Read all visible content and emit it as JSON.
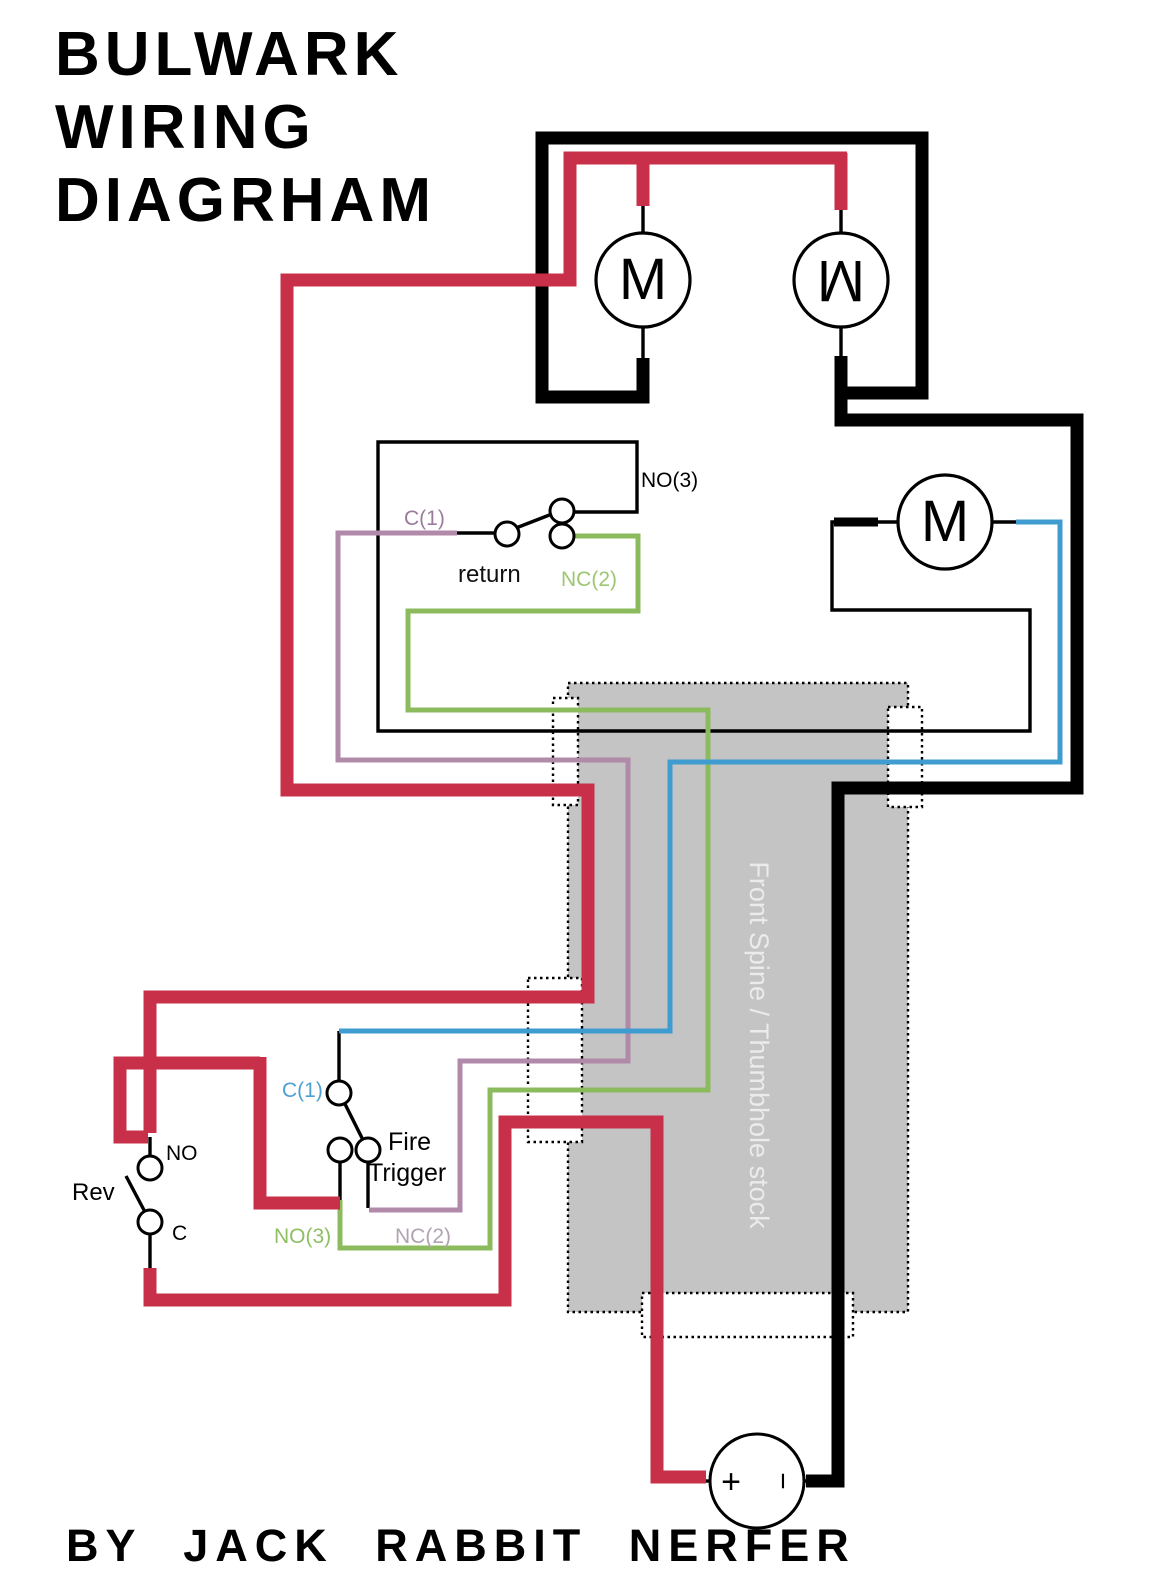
{
  "title": {
    "line1": "BULWARK",
    "line2": "WIRING",
    "line3": "DIAGRHAM"
  },
  "footer": {
    "text": "BY JACK RABBIT NERFER"
  },
  "stock": {
    "label": "Front Spine / Thumbhole stock"
  },
  "motors": {
    "m1": "M",
    "m2": "M",
    "m3": "M"
  },
  "battery": {
    "plus": "+",
    "minus": "−"
  },
  "return_switch": {
    "label": "return",
    "no": "NO(3)",
    "c": "C(1)",
    "nc": "NC(2)"
  },
  "fire_trigger": {
    "label_line1": "Fire",
    "label_line2": "Trigger",
    "c": "C(1)",
    "no": "NO(3)",
    "nc": "NC(2)"
  },
  "rev_switch": {
    "label": "Rev",
    "no": "NO",
    "c": "C"
  },
  "colors": {
    "wire_red": "#c8304a",
    "wire_black": "#000000",
    "wire_green": "#8cbb5e",
    "wire_purple": "#b08aa8",
    "wire_blue": "#3f9cd0",
    "stock_fill": "#c4c4c4",
    "stock_text": "#ebebeb",
    "label_green": "#9cc672",
    "label_purple": "#9b7b9b",
    "label_pale_purple": "#b0a4b0",
    "label_blue": "#4e9fd2"
  }
}
